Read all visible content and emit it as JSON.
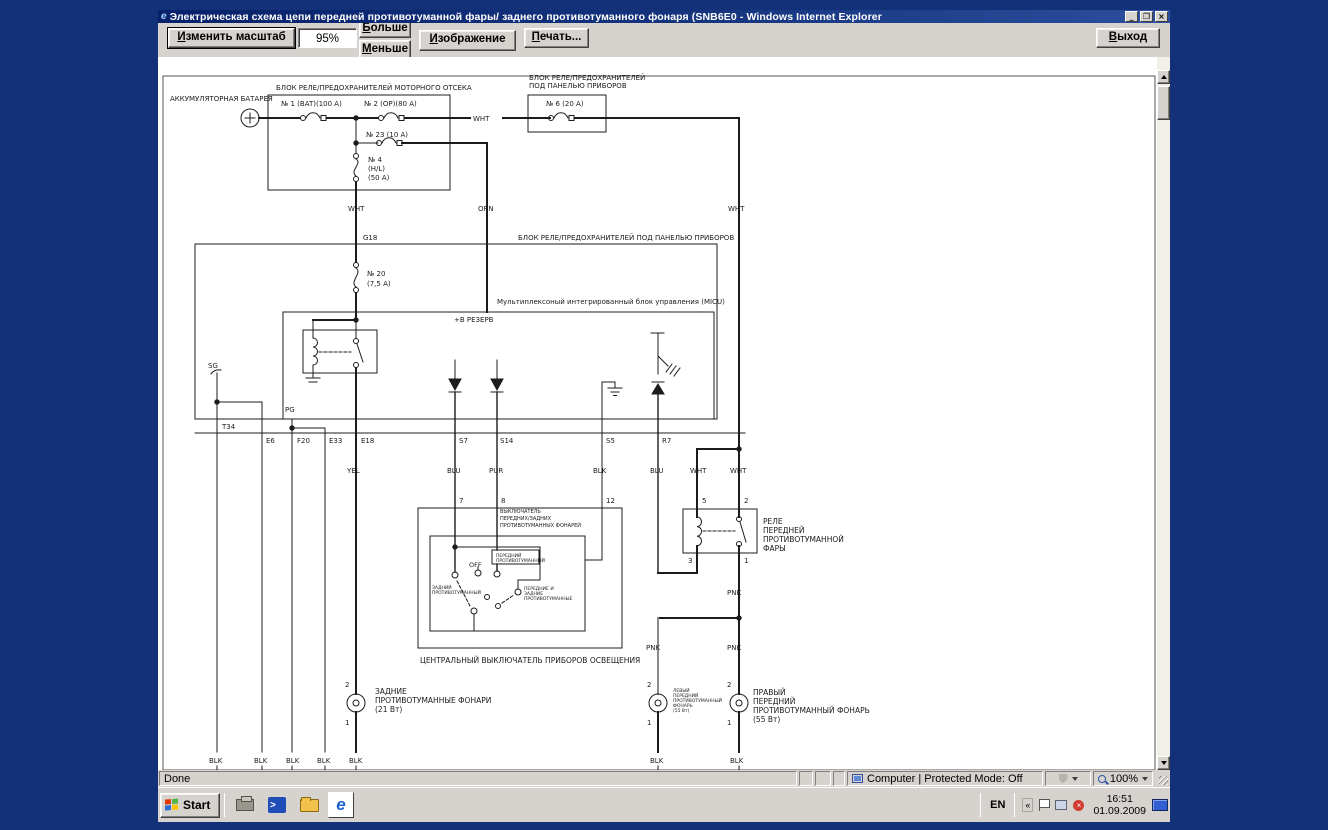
{
  "window": {
    "title": "Электрическая схема цепи передней противотуманной фары/ заднего противотуманного фонаря (SNB6E0 - Windows Internet Explorer"
  },
  "toolbar": {
    "change_scale_label": "Изменить масштаб",
    "zoom_value": "95%",
    "more_label": "Больше",
    "less_label": "Меньше",
    "image_label": "Изображение",
    "print_label": "Печать...",
    "exit_label": "Выход"
  },
  "statusbar": {
    "done": "Done",
    "zone": "Computer | Protected Mode: Off",
    "zoom": "100%"
  },
  "taskbar": {
    "start_label": "Start",
    "language": "EN",
    "time": "16:51",
    "date": "01.09.2009"
  },
  "diagram": {
    "labels": [
      {
        "t": "АККУМУЛЯТОРНАЯ БАТАРЕЯ",
        "x": 170,
        "y": 101,
        "s": 7
      },
      {
        "t": "БЛОК РЕЛЕ/ПРЕДОХРАНИТЕЛЕЙ МОТОРНОГО ОТСЕКА",
        "x": 276,
        "y": 90,
        "s": 7
      },
      {
        "t": "№ 1 (BAT)(100 A)",
        "x": 281,
        "y": 106,
        "s": 7
      },
      {
        "t": "№ 2 (OP)(80 A)",
        "x": 364,
        "y": 106,
        "s": 7
      },
      {
        "t": "WHT",
        "x": 473,
        "y": 121,
        "s": 7
      },
      {
        "t": "БЛОК РЕЛЕ/ПРЕДОХРАНИТЕЛЕЙ",
        "x": 529,
        "y": 80,
        "s": 7
      },
      {
        "t": "ПОД ПАНЕЛЬЮ ПРИБОРОВ",
        "x": 529,
        "y": 88,
        "s": 7
      },
      {
        "t": "№ 6 (20 A)",
        "x": 546,
        "y": 106,
        "s": 7
      },
      {
        "t": "№ 23 (10 A)",
        "x": 366,
        "y": 137,
        "s": 7
      },
      {
        "t": "№ 4",
        "x": 368,
        "y": 162,
        "s": 7
      },
      {
        "t": "(H/L)",
        "x": 368,
        "y": 171,
        "s": 7
      },
      {
        "t": "(50 A)",
        "x": 368,
        "y": 180,
        "s": 7
      },
      {
        "t": "WHT",
        "x": 348,
        "y": 211,
        "s": 7
      },
      {
        "t": "ORN",
        "x": 478,
        "y": 211,
        "s": 7
      },
      {
        "t": "WHT",
        "x": 728,
        "y": 211,
        "s": 7
      },
      {
        "t": "G18",
        "x": 363,
        "y": 240,
        "s": 7
      },
      {
        "t": "БЛОК РЕЛЕ/ПРЕДОХРАНИТЕЛЕЙ ПОД ПАНЕЛЬЮ ПРИБОРОВ",
        "x": 518,
        "y": 240,
        "s": 7
      },
      {
        "t": "№ 20",
        "x": 367,
        "y": 276,
        "s": 7
      },
      {
        "t": "(7,5 A)",
        "x": 367,
        "y": 286,
        "s": 7
      },
      {
        "t": "Мультиплексоный интегрированный блок управления (MICU)",
        "x": 497,
        "y": 304,
        "s": 7
      },
      {
        "t": "+B РЕЗЕРВ",
        "x": 454,
        "y": 322,
        "s": 7
      },
      {
        "t": "SG",
        "x": 208,
        "y": 368,
        "s": 7
      },
      {
        "t": "PG",
        "x": 285,
        "y": 412,
        "s": 7
      },
      {
        "t": "T34",
        "x": 222,
        "y": 429,
        "s": 7
      },
      {
        "t": "E6",
        "x": 266,
        "y": 443,
        "s": 7
      },
      {
        "t": "F20",
        "x": 297,
        "y": 443,
        "s": 7
      },
      {
        "t": "E33",
        "x": 329,
        "y": 443,
        "s": 7
      },
      {
        "t": "E18",
        "x": 361,
        "y": 443,
        "s": 7
      },
      {
        "t": "S7",
        "x": 459,
        "y": 443,
        "s": 7
      },
      {
        "t": "S14",
        "x": 500,
        "y": 443,
        "s": 7
      },
      {
        "t": "S5",
        "x": 606,
        "y": 443,
        "s": 7
      },
      {
        "t": "R7",
        "x": 662,
        "y": 443,
        "s": 7
      },
      {
        "t": "YEL",
        "x": 347,
        "y": 473,
        "s": 7
      },
      {
        "t": "BLU",
        "x": 447,
        "y": 473,
        "s": 7
      },
      {
        "t": "PUR",
        "x": 489,
        "y": 473,
        "s": 7
      },
      {
        "t": "BLK",
        "x": 593,
        "y": 473,
        "s": 7
      },
      {
        "t": "BLU",
        "x": 650,
        "y": 473,
        "s": 7
      },
      {
        "t": "WHT",
        "x": 690,
        "y": 473,
        "s": 7
      },
      {
        "t": "WHT",
        "x": 730,
        "y": 473,
        "s": 7
      },
      {
        "t": "7",
        "x": 459,
        "y": 503,
        "s": 7
      },
      {
        "t": "8",
        "x": 501,
        "y": 503,
        "s": 7
      },
      {
        "t": "12",
        "x": 606,
        "y": 503,
        "s": 7
      },
      {
        "t": "5",
        "x": 702,
        "y": 503,
        "s": 7
      },
      {
        "t": "2",
        "x": 744,
        "y": 503,
        "s": 7
      },
      {
        "t": "ВЫКЛЮЧАТЕЛЬ",
        "x": 500,
        "y": 513,
        "s": 5
      },
      {
        "t": "ПЕРЕДНИХ/ЗАДНИХ",
        "x": 500,
        "y": 520,
        "s": 5
      },
      {
        "t": "ПРОТИВОТУМАННЫХ ФОНАРЕЙ",
        "x": 500,
        "y": 527,
        "s": 5
      },
      {
        "t": "ПЕРЕДНИЙ",
        "x": 496,
        "y": 557,
        "s": 4.5
      },
      {
        "t": "ПРОТИВОТУМАННЫЙ",
        "x": 496,
        "y": 562,
        "s": 4.5
      },
      {
        "t": "OFF",
        "x": 469,
        "y": 567,
        "s": 6.5
      },
      {
        "t": "ЗАДНИЙ",
        "x": 432,
        "y": 589,
        "s": 4.5
      },
      {
        "t": "ПРОТИВОТУМАННЫЙ",
        "x": 432,
        "y": 594,
        "s": 4.5
      },
      {
        "t": "ПЕРЕДНИЕ И",
        "x": 524,
        "y": 590,
        "s": 4.5
      },
      {
        "t": "ЗАДНИЕ",
        "x": 524,
        "y": 595,
        "s": 4.5
      },
      {
        "t": "ПРОТИВОТУМАННЫЕ",
        "x": 524,
        "y": 600,
        "s": 4.5
      },
      {
        "t": "ЦЕНТРАЛЬНЫЙ ВЫКЛЮЧАТЕЛЬ ПРИБОРОВ ОСВЕЩЕНИЯ",
        "x": 420,
        "y": 663,
        "s": 7.5
      },
      {
        "t": "РЕЛЕ",
        "x": 763,
        "y": 524,
        "s": 7.5
      },
      {
        "t": "ПЕРЕДНЕЙ",
        "x": 763,
        "y": 533,
        "s": 7.5
      },
      {
        "t": "ПРОТИВОТУМАННОЙ",
        "x": 763,
        "y": 542,
        "s": 7.5
      },
      {
        "t": "ФАРЫ",
        "x": 763,
        "y": 551,
        "s": 7.5
      },
      {
        "t": "3",
        "x": 688,
        "y": 563,
        "s": 7
      },
      {
        "t": "1",
        "x": 744,
        "y": 563,
        "s": 7
      },
      {
        "t": "PNK",
        "x": 727,
        "y": 595,
        "s": 7
      },
      {
        "t": "PNK",
        "x": 646,
        "y": 650,
        "s": 7
      },
      {
        "t": "PNK",
        "x": 727,
        "y": 650,
        "s": 7
      },
      {
        "t": "2",
        "x": 345,
        "y": 687,
        "s": 7
      },
      {
        "t": "ЗАДНИЕ",
        "x": 375,
        "y": 694,
        "s": 7.5
      },
      {
        "t": "ПРОТИВОТУМАННЫЕ ФОНАРИ",
        "x": 375,
        "y": 703,
        "s": 7.5
      },
      {
        "t": "(21 Вт)",
        "x": 375,
        "y": 712,
        "s": 7.5
      },
      {
        "t": "1",
        "x": 345,
        "y": 725,
        "s": 7
      },
      {
        "t": "2",
        "x": 647,
        "y": 687,
        "s": 7
      },
      {
        "t": "1",
        "x": 647,
        "y": 725,
        "s": 7
      },
      {
        "t": "2",
        "x": 727,
        "y": 687,
        "s": 7
      },
      {
        "t": "1",
        "x": 727,
        "y": 725,
        "s": 7
      },
      {
        "t": "ЛЕВЫЙ",
        "x": 673,
        "y": 692,
        "s": 4.5
      },
      {
        "t": "ПЕРЕДНИЙ",
        "x": 673,
        "y": 697,
        "s": 4.5
      },
      {
        "t": "ПРОТИВОТУМАННЫЙ",
        "x": 673,
        "y": 702,
        "s": 4.5
      },
      {
        "t": "ФОНАРЬ",
        "x": 673,
        "y": 707,
        "s": 4.5
      },
      {
        "t": "(55 Вт)",
        "x": 673,
        "y": 712,
        "s": 4.5
      },
      {
        "t": "ПРАВЫЙ",
        "x": 753,
        "y": 695,
        "s": 7.5
      },
      {
        "t": "ПЕРЕДНИЙ",
        "x": 753,
        "y": 704,
        "s": 7.5
      },
      {
        "t": "ПРОТИВОТУМАННЫЙ ФОНАРЬ",
        "x": 753,
        "y": 713,
        "s": 7.5
      },
      {
        "t": "(55 Вт)",
        "x": 753,
        "y": 722,
        "s": 7.5
      },
      {
        "t": "BLK",
        "x": 209,
        "y": 763,
        "s": 7
      },
      {
        "t": "BLK",
        "x": 254,
        "y": 763,
        "s": 7
      },
      {
        "t": "BLK",
        "x": 286,
        "y": 763,
        "s": 7
      },
      {
        "t": "BLK",
        "x": 317,
        "y": 763,
        "s": 7
      },
      {
        "t": "BLK",
        "x": 349,
        "y": 763,
        "s": 7
      },
      {
        "t": "BLK",
        "x": 650,
        "y": 763,
        "s": 7
      },
      {
        "t": "BLK",
        "x": 730,
        "y": 763,
        "s": 7
      }
    ]
  }
}
